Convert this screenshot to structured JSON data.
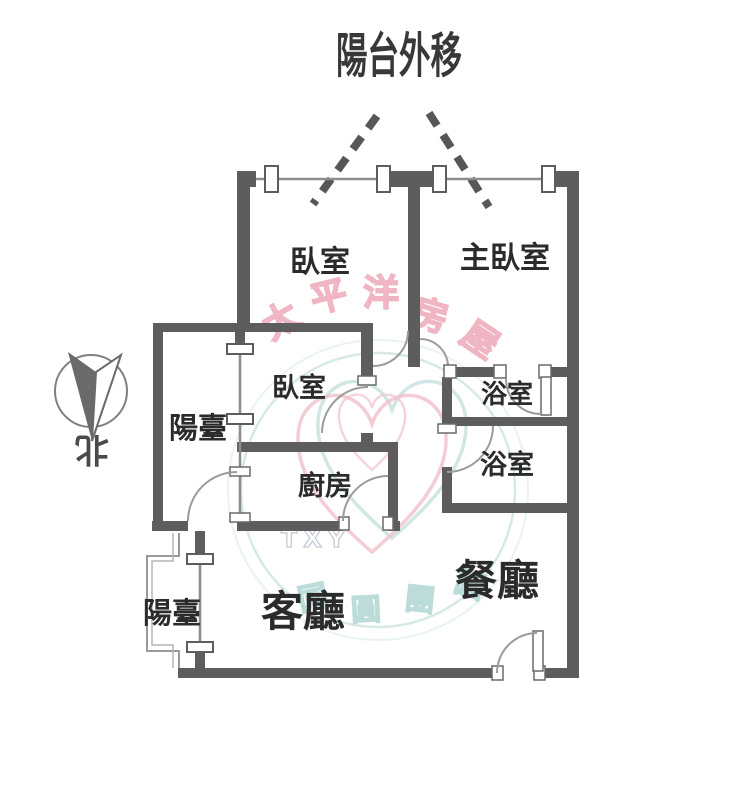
{
  "title": "陽台外移",
  "compass": {
    "label": "北"
  },
  "rooms": {
    "bedroom_top_left": "臥室",
    "master_bedroom": "主臥室",
    "bedroom_middle": "臥室",
    "bathroom_upper": "浴室",
    "bathroom_lower": "浴室",
    "kitchen": "廚房",
    "balcony_left": "陽臺",
    "balcony_lower_left": "陽臺",
    "living_room": "客廳",
    "dining_room": "餐廳"
  },
  "watermark": {
    "brand_chars": [
      "太",
      "平",
      "洋",
      "房",
      "屋"
    ],
    "ring_chars": [
      "同",
      "圓",
      "團",
      "圓"
    ],
    "initials": "TXY"
  },
  "colors": {
    "wall": "#5d5d5d",
    "thin_line": "#8c8c8c",
    "label": "#2b2b2b",
    "watermark_pink": "#ec9fb0",
    "watermark_teal": "#a7d2cd"
  }
}
